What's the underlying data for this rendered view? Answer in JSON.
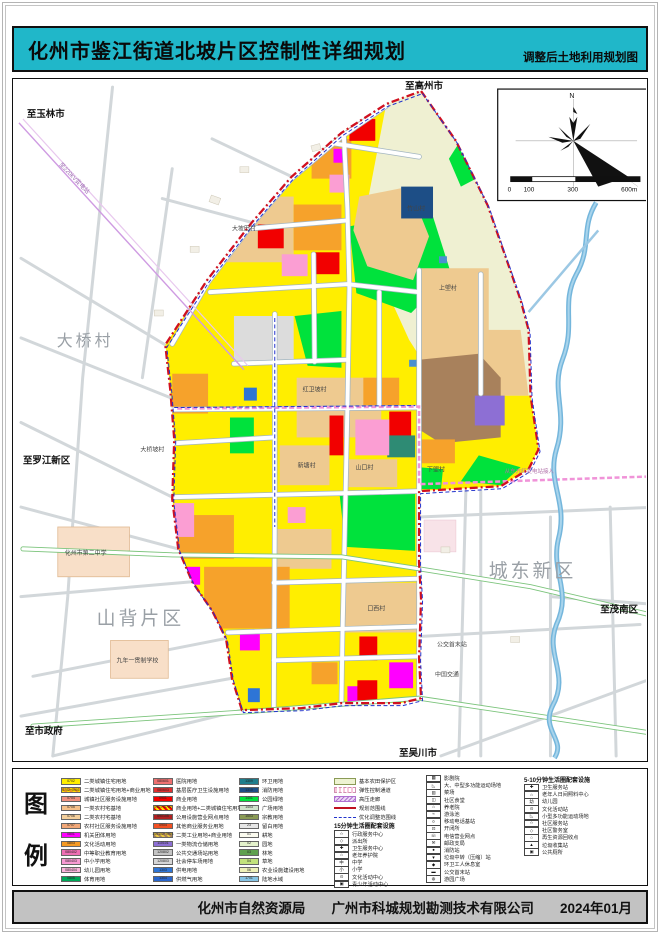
{
  "title": {
    "main": "化州市鉴江街道北坡片区控制性详细规划",
    "sub": "调整后土地利用规划图"
  },
  "footer": {
    "org": "化州市自然资源局",
    "company": "广州市科城规划勘测技术有限公司",
    "date": "2024年01月"
  },
  "legend_panel": {
    "char1": "图",
    "char2": "例"
  },
  "map": {
    "compass_n": "N",
    "scale_ticks": [
      "0",
      "100",
      "300",
      "600m"
    ],
    "labels": {
      "yulin": "至玉林市",
      "gaozhou": "至高州市",
      "luojiang": "至罗江新区",
      "shizhengfu": "至市政府",
      "wuchuan": "至吴川市",
      "maonan": "至茂南区",
      "daqiao": "大桥村",
      "shanbei": "山背片区",
      "chengdong": "城东新区",
      "dapotian": "大坡田村",
      "zhushan": "竹山村",
      "shanglang": "上塱村",
      "hongwei": "红卫坡村",
      "xialang": "下塱村",
      "xintang": "新塘村",
      "shankou": "山口村",
      "kouxi": "口西村",
      "daqiaopo": "大桥坡村",
      "school2": "化州市第二中学",
      "school9": "九年一贯制学校",
      "bus": "公交首末站",
      "jiaotong": "中国交通",
      "hv": "至220kV变电站",
      "corridor": "从东方红变电站接入"
    }
  },
  "colors": {
    "accent_cyan": "#20b7c9",
    "boundary_red": "#d01020",
    "adjust_blue": "#2233cc",
    "corridor_pink": "#f093d8",
    "river_blue": "#74b6dc"
  },
  "legend": {
    "color_columns": [
      [
        {
          "code": "0702",
          "label": "二类城镇住宅用地",
          "fill": "#ffee00"
        },
        {
          "code": "0702+0901",
          "label": "二类城镇住宅用地+商业用地",
          "stripes": [
            "#ffe000",
            "#f59a23"
          ]
        },
        {
          "code": "0704",
          "label": "城镇社区服务设施用地",
          "fill": "#f0907e"
        },
        {
          "code": "0705",
          "label": "一类农村宅基地",
          "fill": "#f5c08a"
        },
        {
          "code": "0706",
          "label": "二类农村宅基地",
          "fill": "#f3cf9b"
        },
        {
          "code": "0707",
          "label": "农村社区服务设施用地",
          "fill": "#f2a878"
        },
        {
          "code": "0801",
          "label": "机关团体用地",
          "fill": "#ff00ff"
        },
        {
          "code": "0803",
          "label": "文化活动用地",
          "fill": "#f59a23"
        },
        {
          "code": "080402",
          "label": "中等职业教育用地",
          "fill": "#ee6eb4"
        },
        {
          "code": "080403",
          "label": "中小学用地",
          "fill": "#f79ad3"
        },
        {
          "code": "080404",
          "label": "幼儿园用地",
          "fill": "#fbb4dc"
        },
        {
          "code": "0805",
          "label": "体育用地",
          "fill": "#00a859"
        }
      ],
      [
        {
          "code": "080601",
          "label": "医院用地",
          "fill": "#ee7070"
        },
        {
          "code": "080603",
          "label": "基层医疗卫生设施用地",
          "fill": "#e03030"
        },
        {
          "code": "0901",
          "label": "商业用地",
          "fill": "#f20000"
        },
        {
          "code": "0901+0702",
          "label": "商业用地+二类城镇住宅用地",
          "stripes": [
            "#f20000",
            "#ffe000"
          ]
        },
        {
          "code": "090105",
          "label": "公用设施营业网点用地",
          "fill": "#b02020"
        },
        {
          "code": "0904",
          "label": "其他商业服务业用地",
          "fill": "#f25022"
        },
        {
          "code": "100102+0901",
          "label": "二类工业用地+商业用地",
          "stripes": [
            "#a8815c",
            "#e8c840"
          ]
        },
        {
          "code": "110101",
          "label": "一类物流仓储用地",
          "fill": "#8d6fd4"
        },
        {
          "code": "120802",
          "label": "公共交通场站用地",
          "fill": "#c4c4c4"
        },
        {
          "code": "120803",
          "label": "社会停车场用地",
          "fill": "#d6d6d6"
        },
        {
          "code": "1303",
          "label": "供电用地",
          "fill": "#2e75d6"
        },
        {
          "code": "1304",
          "label": "供燃气用地",
          "fill": "#2a66cc"
        }
      ],
      [
        {
          "code": "1309",
          "label": "环卫用地",
          "fill": "#1f7d8c"
        },
        {
          "code": "1310",
          "label": "消防用地",
          "fill": "#1d4e86"
        },
        {
          "code": "1401",
          "label": "公园绿地",
          "fill": "#00e23c"
        },
        {
          "code": "1403",
          "label": "广场用地",
          "fill": "#cfe3cb"
        },
        {
          "code": "1503",
          "label": "宗教用地",
          "fill": "#8a9a55"
        },
        {
          "code": "23",
          "label": "留白用地",
          "fill": "#e6e6e6"
        },
        {
          "code": "01",
          "label": "耕地",
          "fill": "#fbfbef"
        },
        {
          "code": "02",
          "label": "园地",
          "fill": "#e4f2cc"
        },
        {
          "code": "03",
          "label": "林地",
          "fill": "#5fa04e"
        },
        {
          "code": "04",
          "label": "草地",
          "fill": "#c2e27c"
        },
        {
          "code": "06",
          "label": "农业设施建设用地",
          "fill": "#eef0b8"
        },
        {
          "code": "1701",
          "label": "陆地水域",
          "fill": "#86c4e4"
        }
      ]
    ],
    "line_items": [
      {
        "kind": "area",
        "label": "基本农田保护区"
      },
      {
        "kind": "elastic",
        "label": "弹性控制通道"
      },
      {
        "kind": "hv",
        "label": "高压走廊"
      },
      {
        "kind": "line-red",
        "label": "规划范围线"
      },
      {
        "kind": "dash-blue",
        "label": "优化调整范围线"
      }
    ],
    "sec15": {
      "title": "15分钟生活圈配套设施",
      "items": [
        {
          "icon": "☆",
          "label": "行政服务中心"
        },
        {
          "icon": "◇",
          "label": "派出所"
        },
        {
          "icon": "✚",
          "label": "卫生服务中心"
        },
        {
          "icon": "⌂",
          "label": "老年养护院"
        },
        {
          "icon": "中",
          "label": "中学"
        },
        {
          "icon": "小",
          "label": "小学"
        },
        {
          "icon": "⊙",
          "label": "文化活动中心"
        },
        {
          "icon": "▣",
          "label": "青少年活动中心"
        }
      ]
    },
    "sec15b": [
      {
        "icon": "▦",
        "label": "影剧院"
      },
      {
        "icon": "◺",
        "label": "大、中型多功能运动场地"
      },
      {
        "icon": "▥",
        "label": "菜场"
      },
      {
        "icon": "◫",
        "label": "社区食堂"
      },
      {
        "icon": "⌂",
        "label": "养老院"
      },
      {
        "icon": "≈",
        "label": "游泳池"
      },
      {
        "icon": "¤",
        "label": "移动电话基站"
      },
      {
        "icon": "⊡",
        "label": "开闭所"
      },
      {
        "icon": "☏",
        "label": "电信营业网点"
      },
      {
        "icon": "✉",
        "label": "邮政支局"
      },
      {
        "icon": "●",
        "label": "消防站"
      },
      {
        "icon": "▼",
        "label": "垃圾中转（压缩）站"
      },
      {
        "icon": "◆",
        "label": "环卫工人休息室"
      },
      {
        "icon": "▬",
        "label": "公交首末站"
      },
      {
        "icon": "◍",
        "label": "游园广场"
      }
    ],
    "sec510": {
      "title": "5-10分钟生活圈配套设施",
      "items": [
        {
          "icon": "✚",
          "label": "卫生服务站"
        },
        {
          "icon": "⌂",
          "label": "老年人日间照料中心"
        },
        {
          "icon": "幼",
          "label": "幼儿园"
        },
        {
          "icon": "⊙",
          "label": "文化活动站"
        },
        {
          "icon": "◺",
          "label": "小型多功能运动场地"
        },
        {
          "icon": "☆",
          "label": "社区服务站"
        },
        {
          "icon": "◇",
          "label": "社区警务室"
        },
        {
          "icon": "○",
          "label": "再生资源回收点"
        },
        {
          "icon": "▲",
          "label": "垃圾收集站"
        },
        {
          "icon": "▣",
          "label": "公共厕所"
        }
      ]
    }
  }
}
